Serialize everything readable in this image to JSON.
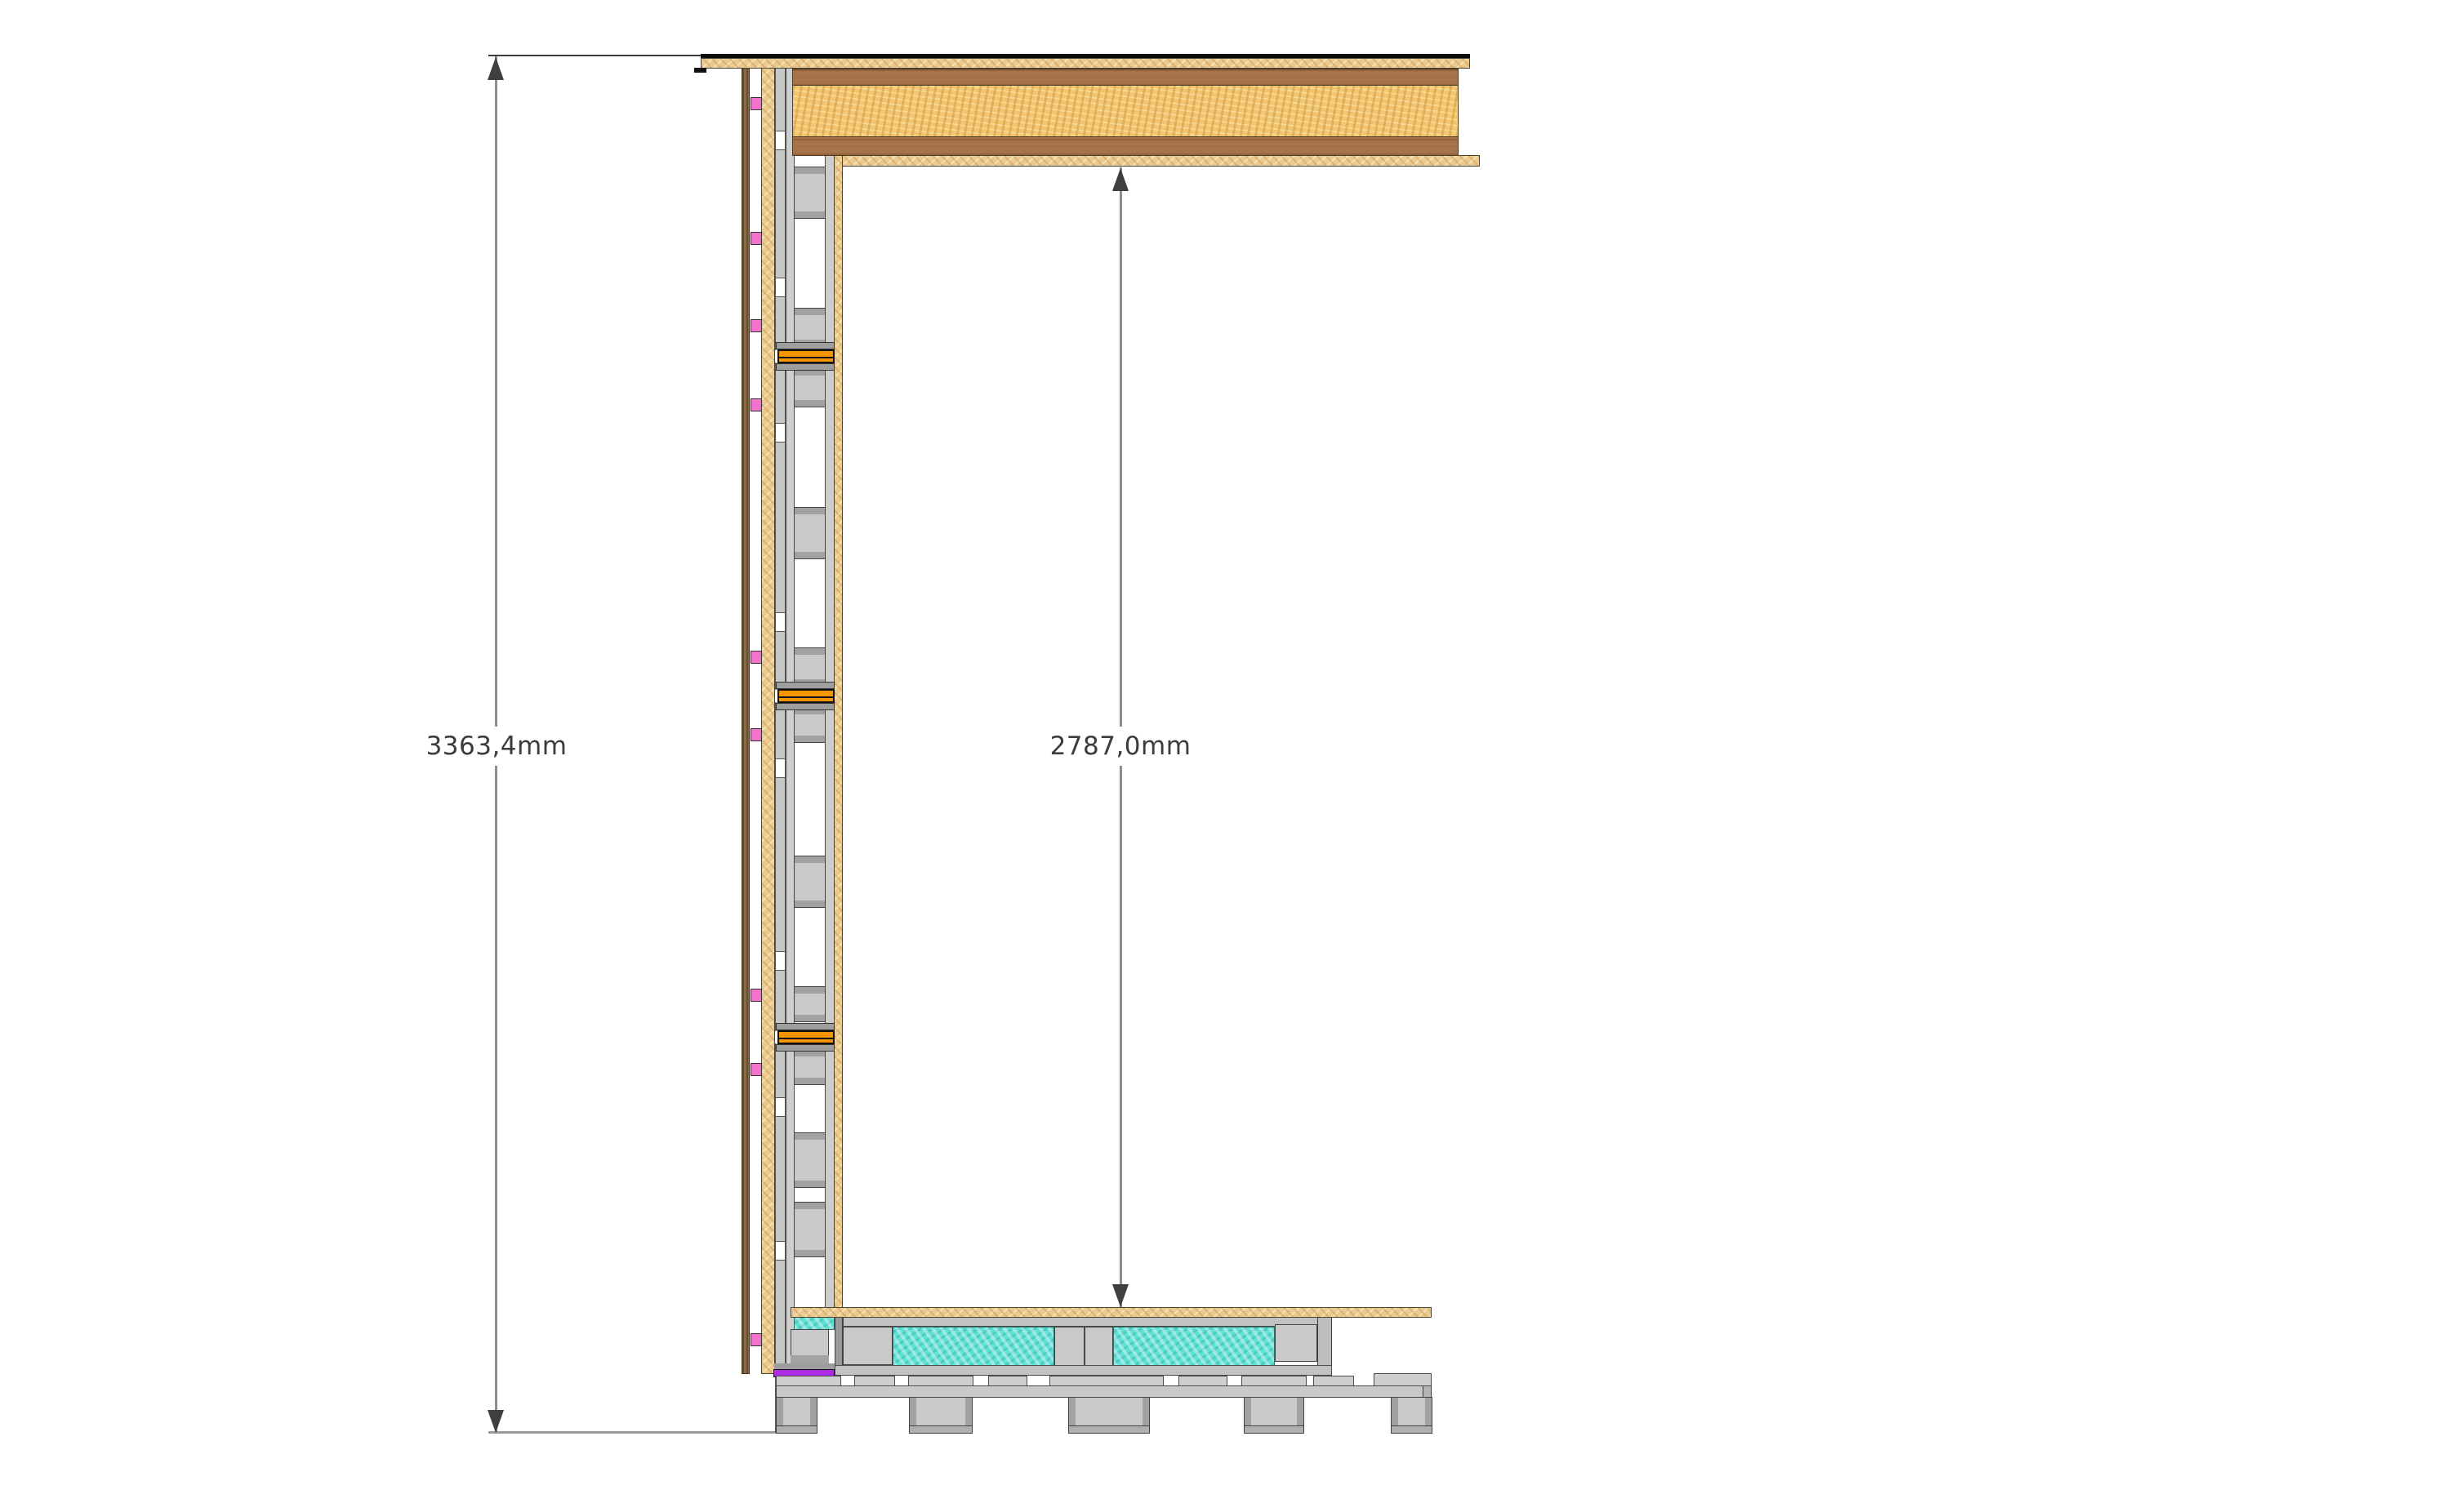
{
  "drawing": {
    "dimensions": {
      "overall_height": {
        "label": "3363,4mm"
      },
      "clear_height": {
        "label": "2787,0mm"
      }
    },
    "colors": {
      "osb": "#EBC98F",
      "osb_core": "#F1C571",
      "wood": "#A6744A",
      "cladding": "#8A6A45",
      "pink": "#F273C9",
      "orange": "#F79500",
      "cyan": "#5FE1D6",
      "purple": "#AA2BE1",
      "gray_fill": "#C9C9C9",
      "gray_light": "#D4D4D4",
      "gray_dark": "#A2A2A2",
      "outline": "#3C3C3C",
      "dim_line": "#8C8C8C",
      "dim_text": "#3C3C3C",
      "arrow": "#3F3F3F",
      "membrane": "#0A0A0A"
    }
  }
}
